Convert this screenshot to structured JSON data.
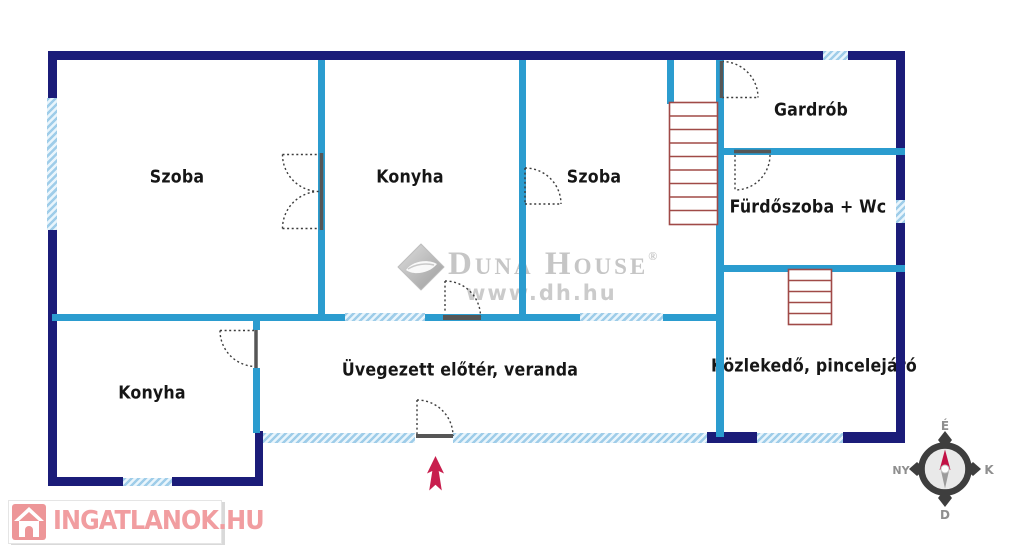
{
  "floorplan": {
    "rooms": [
      {
        "id": "szoba-1",
        "label": "Szoba"
      },
      {
        "id": "konyha-top",
        "label": "Konyha"
      },
      {
        "id": "szoba-2",
        "label": "Szoba"
      },
      {
        "id": "gardrob",
        "label": "Gardrób"
      },
      {
        "id": "furdoszoba-wc",
        "label": "Fürdőszoba + Wc"
      },
      {
        "id": "kozlekedo-pincelejaro",
        "label": "Közlekedő, pincelejáró"
      },
      {
        "id": "uvegezett-eloter-veranda",
        "label": "Üvegezett előtér, veranda"
      },
      {
        "id": "konyha-bottom",
        "label": "Konyha"
      }
    ],
    "colors": {
      "outer_wall": "#1b1c79",
      "inner_wall": "#2b9ccf",
      "window_fill": "#a5d2eb",
      "stairs": "#a04a47",
      "entrance_arrow": "#c81f4e",
      "label_text": "#161616"
    }
  },
  "watermark": {
    "brand": "Duna House",
    "registered": "®",
    "url": "www.dh.hu"
  },
  "branding": {
    "portal": "INGATLANOK.HU"
  },
  "compass": {
    "north": "É",
    "south": "D",
    "west": "NY",
    "east": "K"
  }
}
